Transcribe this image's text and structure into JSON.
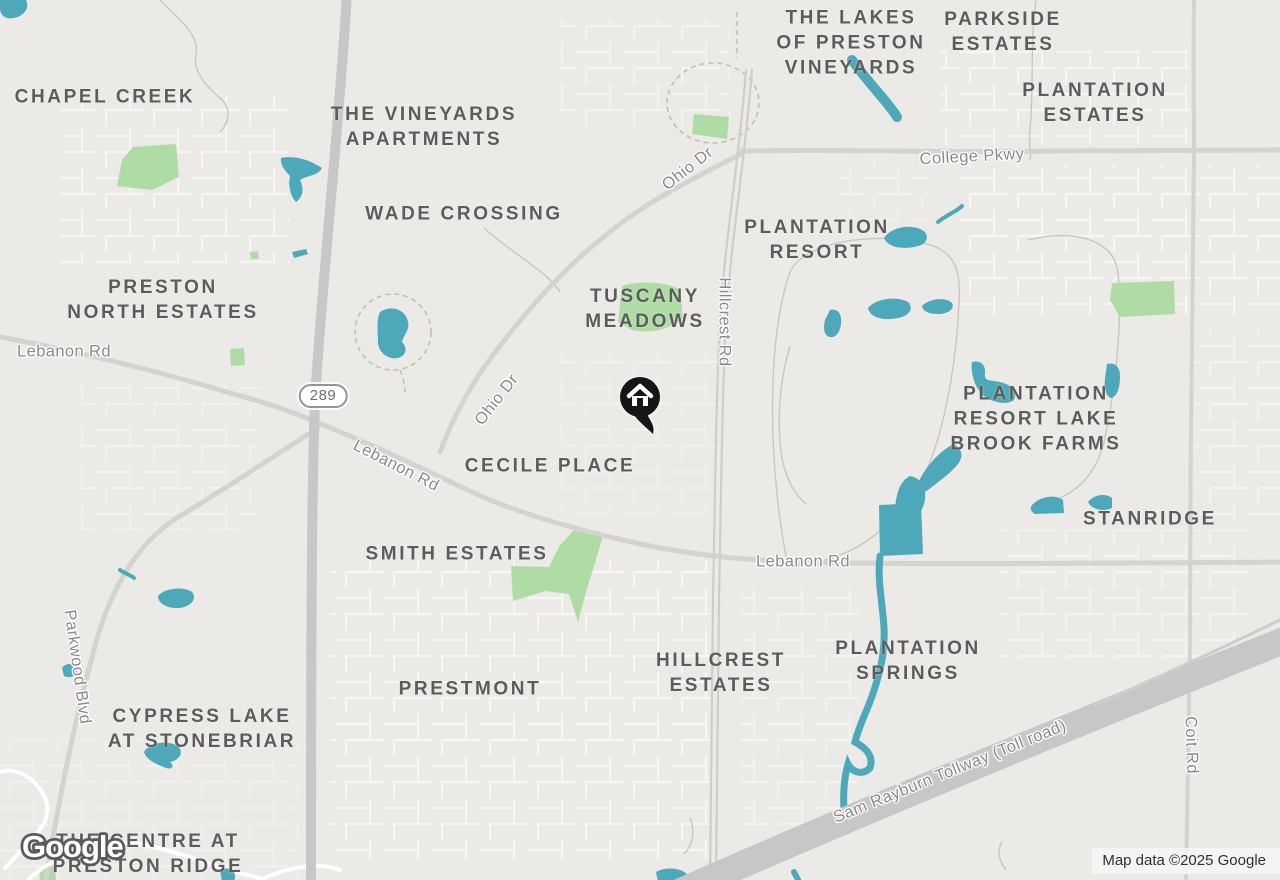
{
  "map": {
    "google_logo": "Google",
    "attribution": "Map data ©2025 Google",
    "marker": {
      "type": "home",
      "x": 640,
      "y": 397
    },
    "highway_shield": {
      "label": "289",
      "x": 323,
      "y": 396
    },
    "colors": {
      "background": "#ECEAE6",
      "water": "#4DA9BA",
      "park": "#AEDCA4",
      "road_major": "#C7C7C7",
      "road_minor": "#FFFFFF",
      "neighborhood_label": "#5C5C5C",
      "road_label": "#8A8A8A"
    },
    "neighborhood_labels": [
      {
        "text": "CHAPEL CREEK",
        "x": 105,
        "y": 97
      },
      {
        "text": "THE VINEYARDS\nAPARTMENTS",
        "x": 424,
        "y": 127
      },
      {
        "text": "WADE CROSSING",
        "x": 464,
        "y": 214
      },
      {
        "text": "PRESTON\nNORTH ESTATES",
        "x": 163,
        "y": 300
      },
      {
        "text": "THE LAKES\nOF PRESTON\nVINEYARDS",
        "x": 851,
        "y": 43
      },
      {
        "text": "PARKSIDE\nESTATES",
        "x": 1003,
        "y": 32
      },
      {
        "text": "PLANTATION\nESTATES",
        "x": 1095,
        "y": 103
      },
      {
        "text": "PLANTATION\nRESORT",
        "x": 817,
        "y": 240
      },
      {
        "text": "TUSCANY\nMEADOWS",
        "x": 645,
        "y": 309
      },
      {
        "text": "PLANTATION\nRESORT LAKE\nBROOK FARMS",
        "x": 1036,
        "y": 419
      },
      {
        "text": "STANRIDGE",
        "x": 1150,
        "y": 519
      },
      {
        "text": "CECILE PLACE",
        "x": 550,
        "y": 466
      },
      {
        "text": "SMITH ESTATES",
        "x": 457,
        "y": 554
      },
      {
        "text": "PRESTMONT",
        "x": 470,
        "y": 689
      },
      {
        "text": "HILLCREST\nESTATES",
        "x": 721,
        "y": 673
      },
      {
        "text": "PLANTATION\nSPRINGS",
        "x": 908,
        "y": 661
      },
      {
        "text": "CYPRESS LAKE\nAT STONEBRIAR",
        "x": 202,
        "y": 729
      },
      {
        "text": "THE CENTRE AT\nPRESTON RIDGE",
        "x": 148,
        "y": 854
      }
    ],
    "road_labels": [
      {
        "text": "Ohio Dr",
        "x": 688,
        "y": 169,
        "rot": -38
      },
      {
        "text": "College Pkwy",
        "x": 972,
        "y": 157,
        "rot": -3
      },
      {
        "text": "Hillcrest Rd",
        "x": 724,
        "y": 322,
        "rot": 90
      },
      {
        "text": "Lebanon Rd",
        "x": 64,
        "y": 352,
        "rot": 0
      },
      {
        "text": "Ohio Dr",
        "x": 497,
        "y": 400,
        "rot": -52
      },
      {
        "text": "Lebanon Rd",
        "x": 396,
        "y": 466,
        "rot": 27
      },
      {
        "text": "Lebanon Rd",
        "x": 803,
        "y": 562,
        "rot": 0
      },
      {
        "text": "Parkwood Blvd",
        "x": 77,
        "y": 667,
        "rot": 82
      },
      {
        "text": "Sam Rayburn Tollway (Toll road)",
        "x": 950,
        "y": 772,
        "rot": -22
      },
      {
        "text": "Coit Rd",
        "x": 1191,
        "y": 745,
        "rot": 88
      }
    ]
  }
}
